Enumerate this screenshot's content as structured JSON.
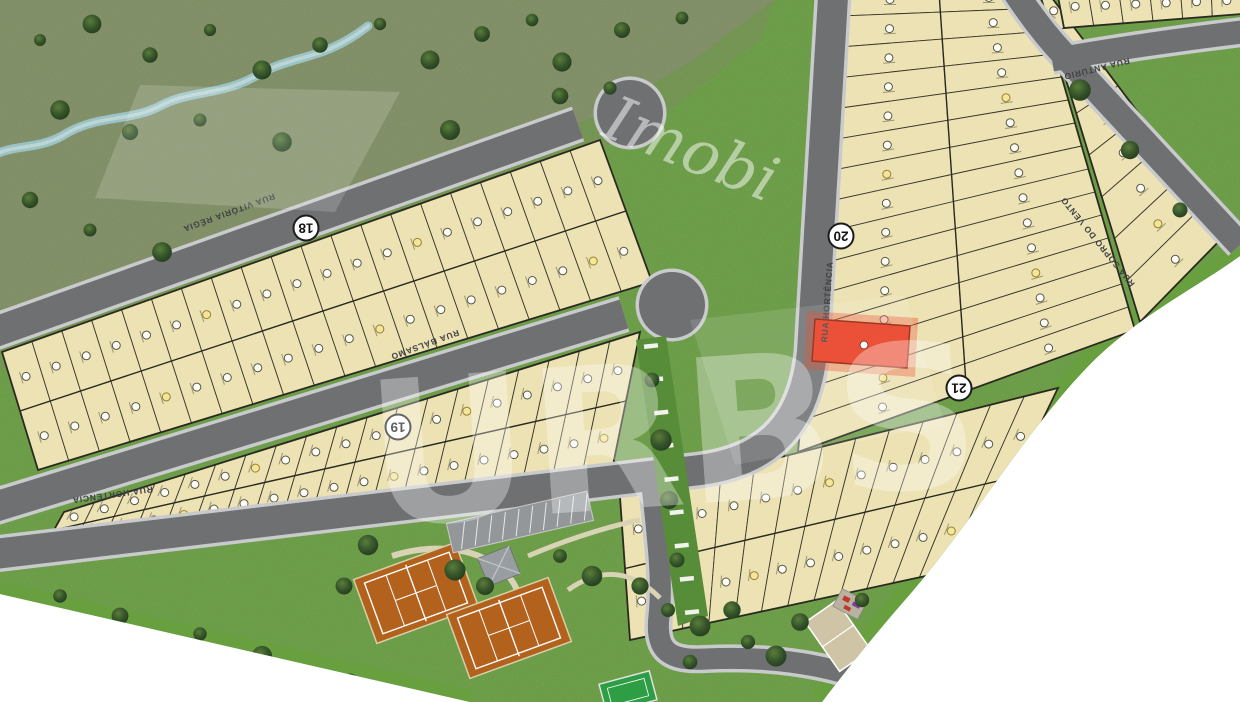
{
  "map": {
    "streets": [
      {
        "id": "vitoria-regia",
        "name": "RUA VITÓRIA RÉGIA"
      },
      {
        "id": "balsamo",
        "name": "RUA BÁLSAMO"
      },
      {
        "id": "hortencia",
        "name": "RUA HORTÊNCIA"
      },
      {
        "id": "hortencia-2",
        "name": "RUA HORTÊNCIA"
      },
      {
        "id": "anturio",
        "name": "RUA ANTÚRIO"
      },
      {
        "id": "sopro-do-vento",
        "name": "RUA SOPRO DO VENTO"
      }
    ],
    "blocks": [
      {
        "label": "18"
      },
      {
        "label": "19"
      },
      {
        "label": "20"
      },
      {
        "label": "21"
      }
    ],
    "highlighted_lot": {
      "status": "highlighted",
      "fill": "#e8391d",
      "near_street": "RUA HORTÊNCIA"
    },
    "features": [
      "preserved-green-area",
      "stream",
      "open-field",
      "tennis-court",
      "tennis-court",
      "gazebo",
      "parking-bays",
      "pedestrian-corridor",
      "sand-court",
      "sports-court",
      "playground",
      "cul-de-sac",
      "cul-de-sac"
    ],
    "watermark": {
      "script_text": "Imobi",
      "monogram": "URBS"
    },
    "colors": {
      "lot_fill": "#ece2b4",
      "lot_border": "#3a392c",
      "road": "#6e7072",
      "curb": "#c9cacb",
      "grass": "#77ac50",
      "preserve": "#8e9d72",
      "stream": "#a9d6d8",
      "highlight": "#e8391d",
      "court_clay": "#b3621e",
      "verge": "#68a03f"
    }
  }
}
